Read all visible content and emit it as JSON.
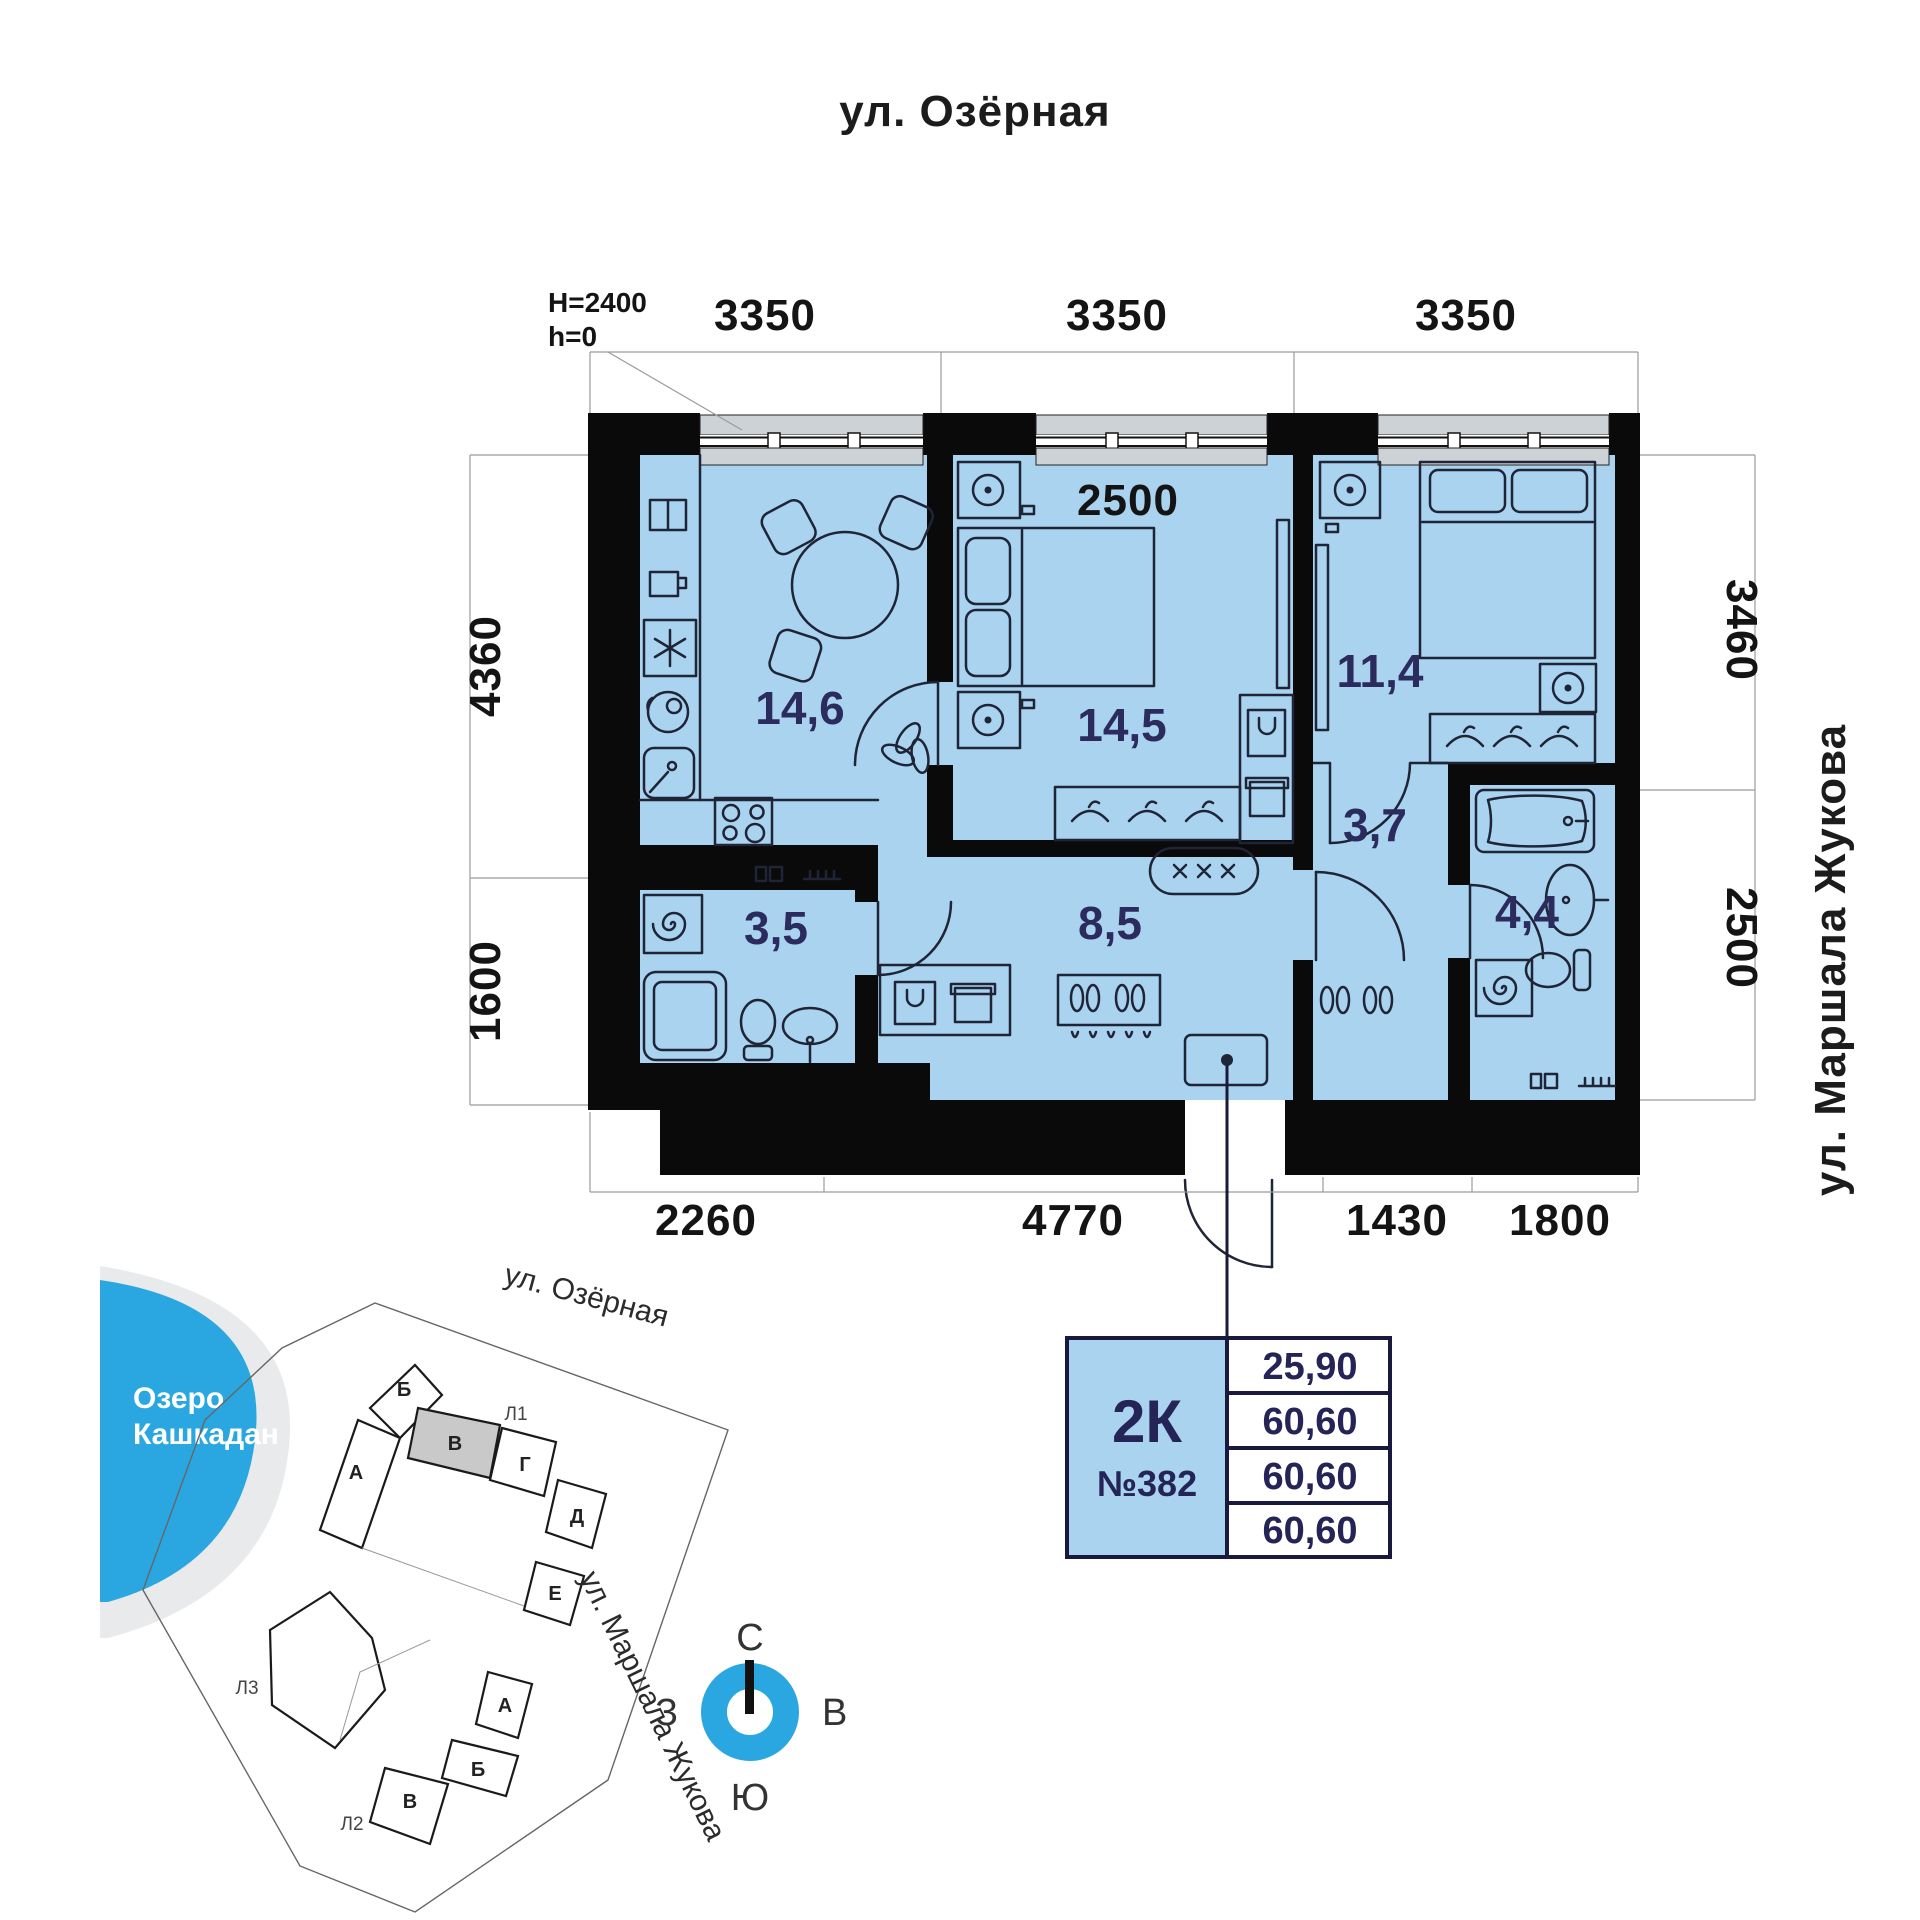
{
  "street_top": "ул. Озёрная",
  "street_right": "ул. Маршала Жукова",
  "plan": {
    "height_note": {
      "line1": "H=2400",
      "line2": "h=0"
    },
    "dims_top": [
      "3350",
      "3350",
      "3350"
    ],
    "inner_dim": "2500",
    "dims_left": [
      "4360",
      "1600"
    ],
    "dims_right": [
      "3460",
      "2500"
    ],
    "dims_bottom": [
      "2260",
      "4770",
      "1430",
      "1800"
    ],
    "rooms": {
      "kitchen": "14,6",
      "bedroom1": "14,5",
      "bedroom2": "11,4",
      "hall": "8,5",
      "corridor": "3,7",
      "bathroom": "4,4",
      "shower": "3,5"
    }
  },
  "site": {
    "lake": {
      "line1": "Озеро",
      "line2": "Кашкадан"
    },
    "street_top": "ул. Озёрная",
    "street_right": "ул. Маршала Жукова",
    "buildings": {
      "l1": "Л1",
      "l2": "Л2",
      "l3": "Л3"
    },
    "sections_l1": {
      "a": "А",
      "b": "Б",
      "v": "В",
      "g": "Г",
      "d": "Д",
      "e": "Е"
    },
    "sections_l2": {
      "a": "А",
      "b": "Б",
      "v": "В"
    }
  },
  "card": {
    "type": "2К",
    "number": "№382",
    "rows": [
      "25,90",
      "60,60",
      "60,60",
      "60,60"
    ]
  },
  "compass": {
    "n": "С",
    "s": "Ю",
    "w": "З",
    "e": "В"
  },
  "colors": {
    "room_fill": "#A9D3EF",
    "wall": "#0A0A0A",
    "accent": "#2AA7E0",
    "label": "#2B2B5E",
    "window": "#CDD2D6",
    "highlight_section": "#C9C9C9"
  }
}
